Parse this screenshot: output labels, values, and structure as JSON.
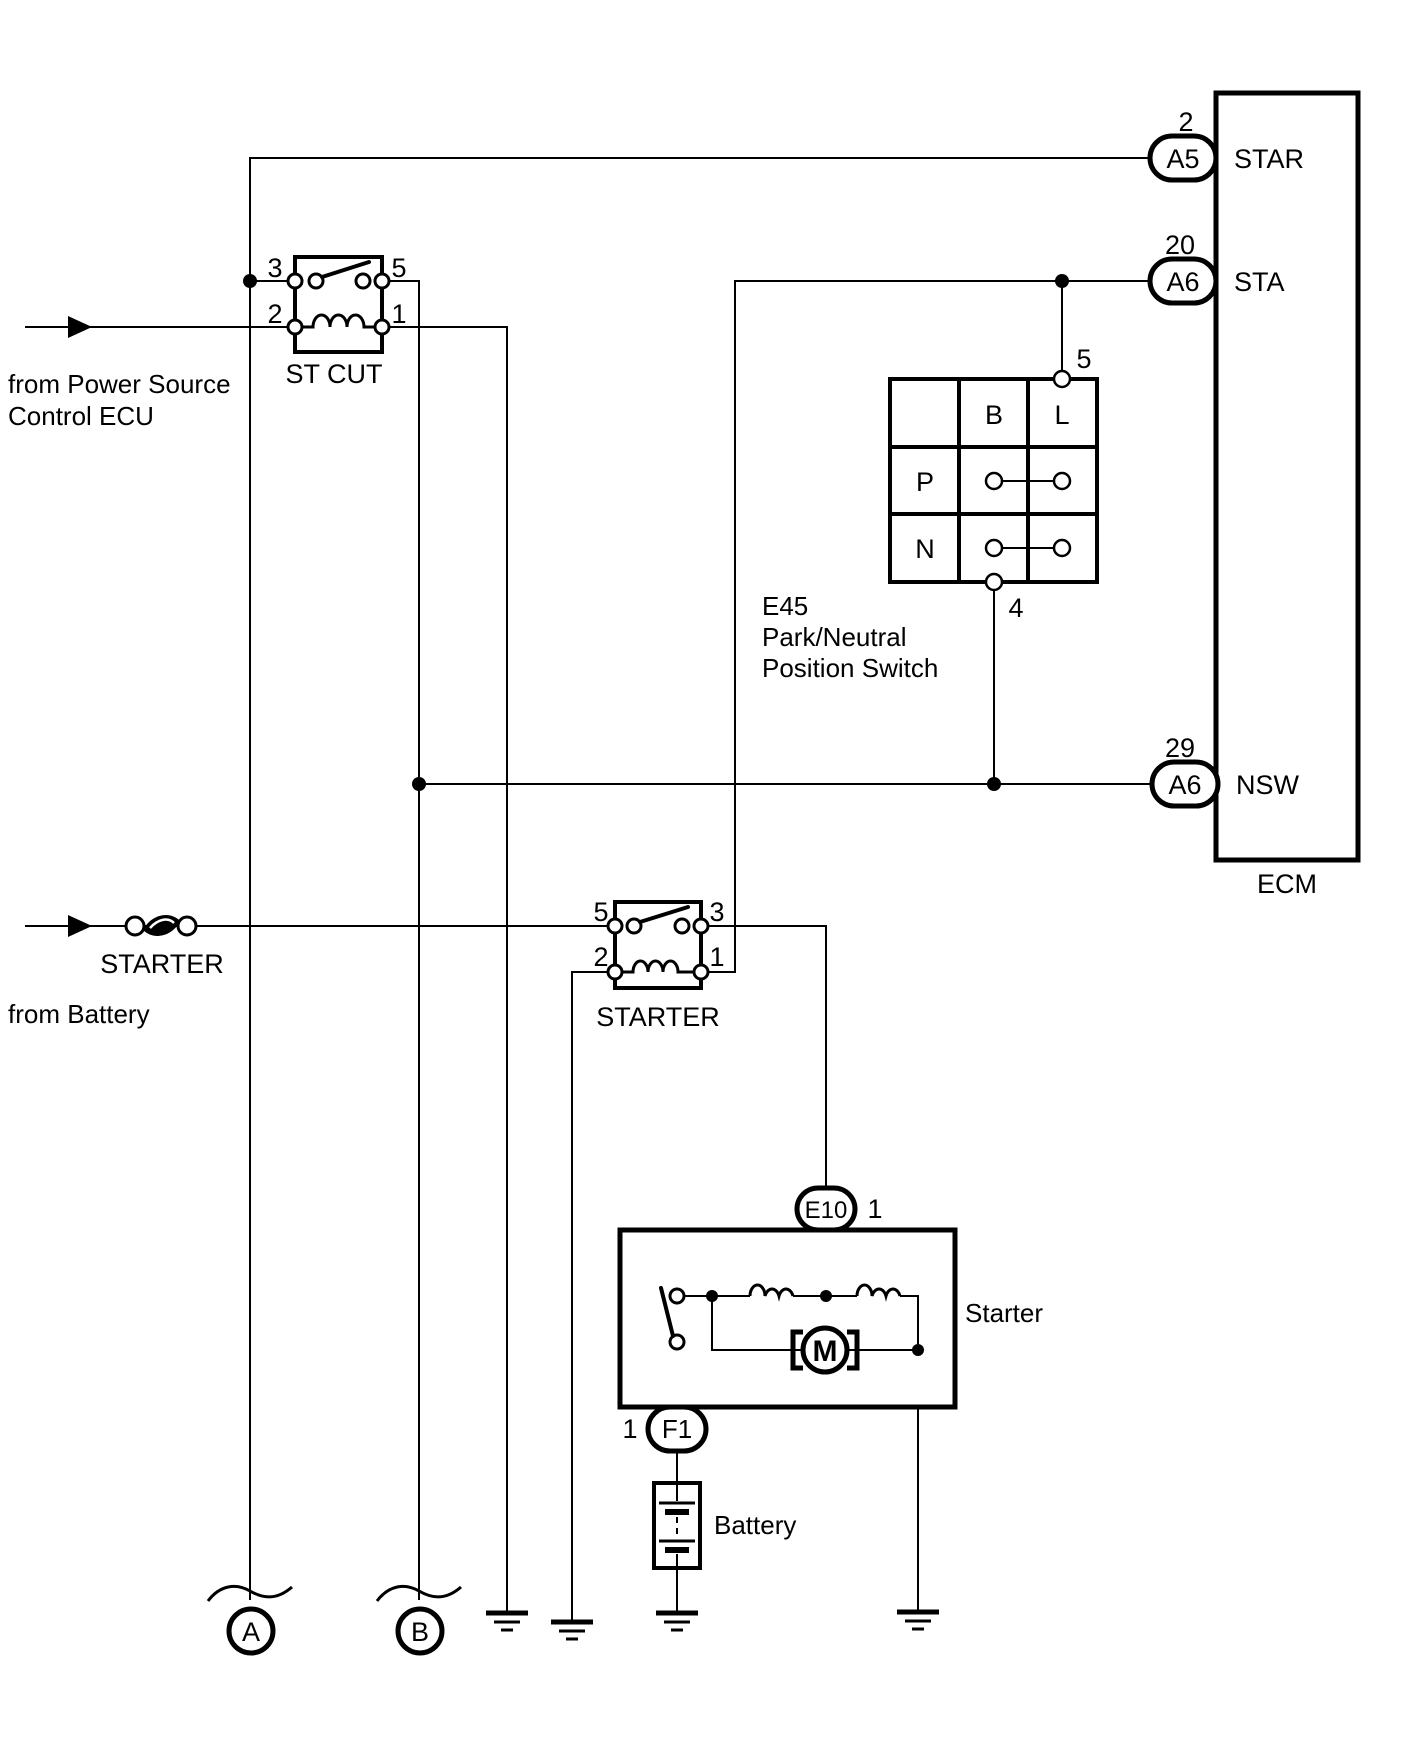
{
  "ecm": {
    "label": "ECM",
    "pins": [
      {
        "num": "2",
        "conn": "A5",
        "signal": "STAR"
      },
      {
        "num": "20",
        "conn": "A6",
        "signal": "STA"
      },
      {
        "num": "29",
        "conn": "A6",
        "signal": "NSW"
      }
    ]
  },
  "st_cut_relay": {
    "label": "ST CUT",
    "num_tl": "3",
    "num_tr": "5",
    "num_bl": "2",
    "num_br": "1"
  },
  "starter_relay": {
    "label": "STARTER",
    "num_tl": "5",
    "num_tr": "3",
    "num_bl": "2",
    "num_br": "1"
  },
  "pnp_switch": {
    "id": "E45",
    "name_line1": "Park/Neutral",
    "name_line2": "Position Switch",
    "col_b": "B",
    "col_l": "L",
    "row_p": "P",
    "row_n": "N",
    "pin_top": "5",
    "pin_bottom": "4"
  },
  "starter_unit": {
    "label": "Starter",
    "motor": "M",
    "top_connector": {
      "id": "E10",
      "pin": "1"
    },
    "bottom_connector": {
      "id": "F1",
      "pin": "1"
    }
  },
  "battery": {
    "label": "Battery"
  },
  "fuse": {
    "label": "STARTER"
  },
  "sources": {
    "power_line1": "from Power Source",
    "power_line2": "Control ECU",
    "battery_note": "from Battery"
  },
  "refs": {
    "a": "A",
    "b": "B"
  }
}
